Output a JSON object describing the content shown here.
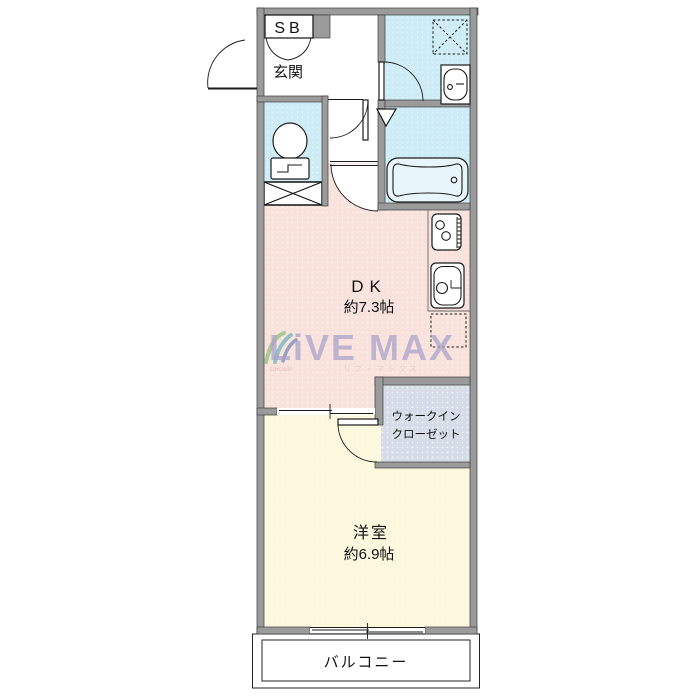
{
  "title": "1DK 間取り図",
  "labels": {
    "sb": "SB",
    "entrance": "玄関",
    "dk": "DK",
    "dk_size": "約7.3帖",
    "wic_line1": "ウォークイン",
    "wic_line2": "クローゼット",
    "western_room": "洋室",
    "western_room_size": "約6.9帖",
    "balcony": "バルコニー"
  },
  "watermark": {
    "brand": "LiVE MAX",
    "group_label": "GROUP",
    "sub_text": "リブ・マックス"
  },
  "colors": {
    "wall": "#9b9b9b",
    "wet_area": "#cdecf5",
    "dk": "#f9e2dc",
    "western_room": "#fbf8dd",
    "closet": "#d6dde8",
    "balcony": "#ffffff",
    "watermark": "#a8a2cb"
  }
}
